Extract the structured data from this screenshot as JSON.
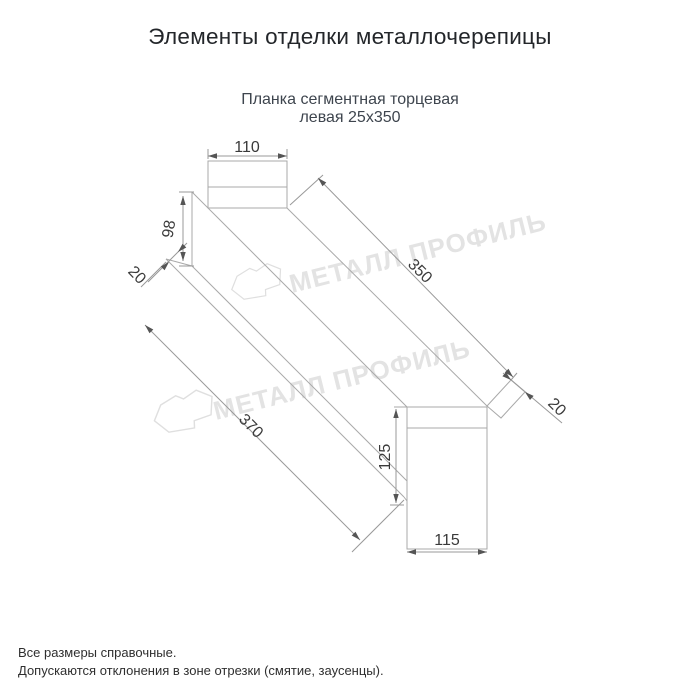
{
  "page": {
    "title": "Элементы отделки металлочерепицы",
    "subtitle1": "Планка сегментная торцевая",
    "subtitle2": "левая 25х350"
  },
  "watermark": {
    "brand": "МЕТАЛЛ ПРОФИЛЬ"
  },
  "drawing": {
    "type": "isometric technical drawing of segmented left end (gable) trim strip",
    "dims": {
      "top_width": "110",
      "left_height": "98",
      "left_fold": "20",
      "length_outer": "350",
      "right_fold": "20",
      "length_inner": "370",
      "right_height": "125",
      "bottom_width": "115"
    }
  },
  "footnotes": {
    "line1": "Все размеры справочные.",
    "line2": "Допускаются отклонения в зоне отрезки (смятие, заусенцы)."
  },
  "colors": {
    "background": "#ffffff",
    "title": "#23262a",
    "subtitle": "#3e454e",
    "edge_line": "#a9a9a9",
    "dim_line": "#999999",
    "dim_text": "#3a3a3a",
    "arrow": "#555555",
    "watermark": "#e3e3e3",
    "footnote": "#2f2f2f"
  }
}
